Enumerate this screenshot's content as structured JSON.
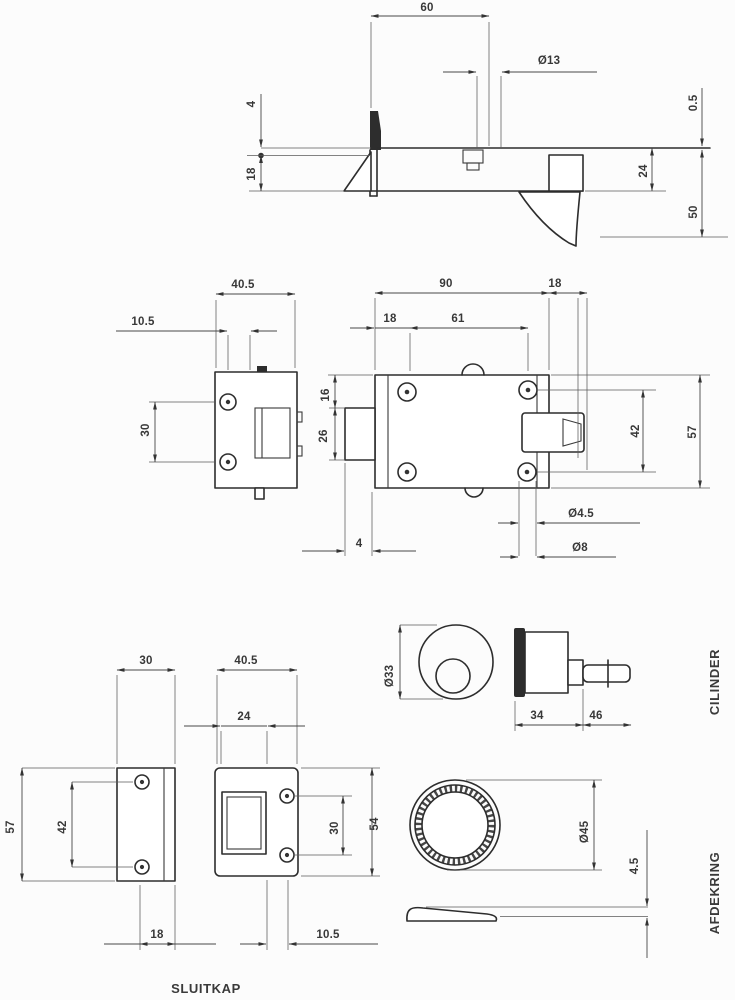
{
  "side_view": {
    "backset": "60",
    "cyl_hole": "Ø13",
    "lip": "4",
    "face_h": "18",
    "gap": "0.5",
    "case_depth": "24",
    "total_depth": "50"
  },
  "end_view": {
    "width": "40.5",
    "offset": "10.5",
    "screw_span": "30"
  },
  "front_view": {
    "width": "90",
    "bolt_throw": "18",
    "backset": "18",
    "screw_width": "61",
    "top_gap": "16",
    "cyl_height": "26",
    "screw_height": "42",
    "height": "57",
    "plate": "4",
    "hole_small": "Ø4.5",
    "hole_large": "Ø8"
  },
  "keep_side": {
    "width": "30",
    "height": "57",
    "screw_span": "42",
    "edge": "18"
  },
  "keep_front": {
    "width": "40.5",
    "opening": "24",
    "screw_span": "30",
    "height": "54",
    "edge": "10.5",
    "caption": "SLUITKAP"
  },
  "cylinder": {
    "caption": "CILINDER",
    "dia": "Ø33",
    "body_len": "34",
    "tail_len": "46"
  },
  "ring": {
    "caption": "AFDEKRING",
    "dia": "Ø45",
    "thickness": "4.5"
  }
}
